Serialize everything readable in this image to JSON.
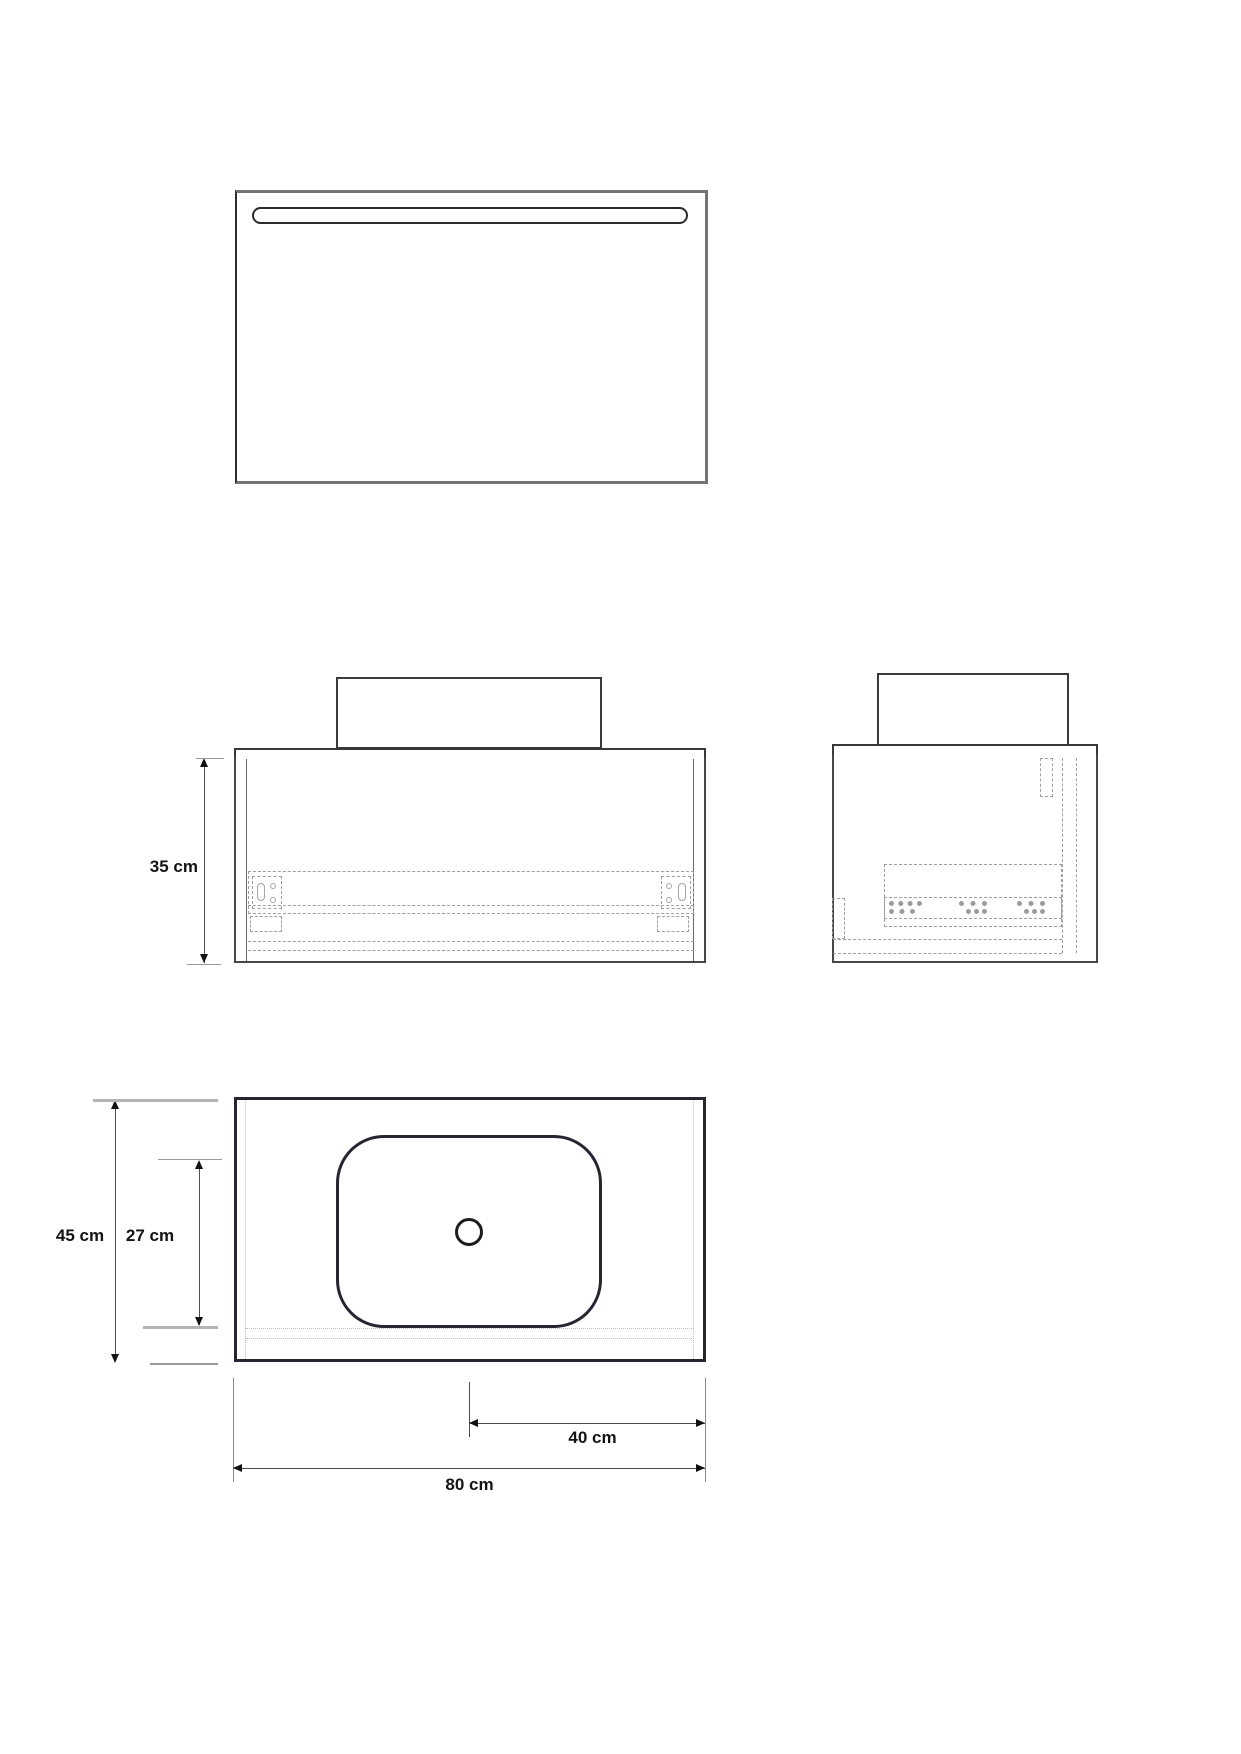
{
  "drawing": {
    "title": "vanity-technical-drawing",
    "dimensions": {
      "front_height": "35 cm",
      "overall_depth": "45 cm",
      "basin_depth": "27 cm",
      "basin_center_to_edge": "40 cm",
      "overall_width": "80 cm"
    },
    "colors": {
      "background": "#ffffff",
      "outline_dark": "#262633",
      "outline_medium": "#3f3f3f",
      "mirror_frame": "#757575",
      "hardware_dashed": "#9f9f9f",
      "construction_dotted": "#bdbdbd",
      "dimension_line": "#4d4d4d",
      "arrowhead": "#111111",
      "label_text": "#131313"
    }
  }
}
